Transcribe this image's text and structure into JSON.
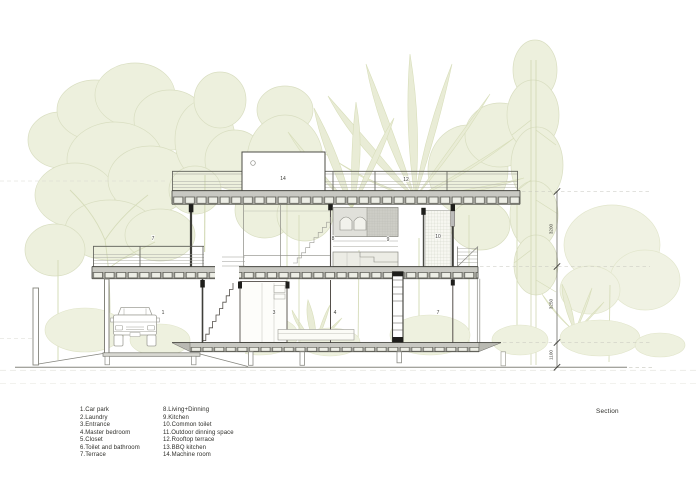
{
  "drawing": {
    "title": "Section"
  },
  "legend": {
    "left": [
      "1.Car park",
      "2.Laundry",
      "3.Entrance",
      "4.Master bedroom",
      "5.Closet",
      "6.Toilet and bathroom",
      "7.Terrace"
    ],
    "right": [
      "8.Living+Dinning",
      "9.Kitchen",
      "10.Common toilet",
      "11.Outdoor dinning space",
      "12.Rooftop terrace",
      "13.BBQ kitchen",
      "14.Machine room"
    ]
  },
  "plan_labels": [
    {
      "text": "14",
      "x": 283,
      "y": 180
    },
    {
      "text": "12",
      "x": 406,
      "y": 181
    },
    {
      "text": "7",
      "x": 153,
      "y": 240
    },
    {
      "text": "8",
      "x": 333,
      "y": 240
    },
    {
      "text": "9",
      "x": 388,
      "y": 241
    },
    {
      "text": "10",
      "x": 438,
      "y": 238
    },
    {
      "text": "1",
      "x": 163,
      "y": 314
    },
    {
      "text": "3",
      "x": 274,
      "y": 314
    },
    {
      "text": "4",
      "x": 335,
      "y": 314
    },
    {
      "text": "7",
      "x": 438,
      "y": 314
    }
  ],
  "dimensions": [
    {
      "value": "3200",
      "x": 552.5,
      "y": 229
    },
    {
      "value": "3250",
      "x": 552.5,
      "y": 304
    },
    {
      "value": "1100",
      "x": 552.5,
      "y": 355
    }
  ],
  "colors": {
    "tree_fill": "#edf0dd",
    "tree_line": "#d9dec1",
    "ink": "#3c3c37",
    "slab_fill": "#c8c8c2",
    "ground_line": "#85857e"
  }
}
